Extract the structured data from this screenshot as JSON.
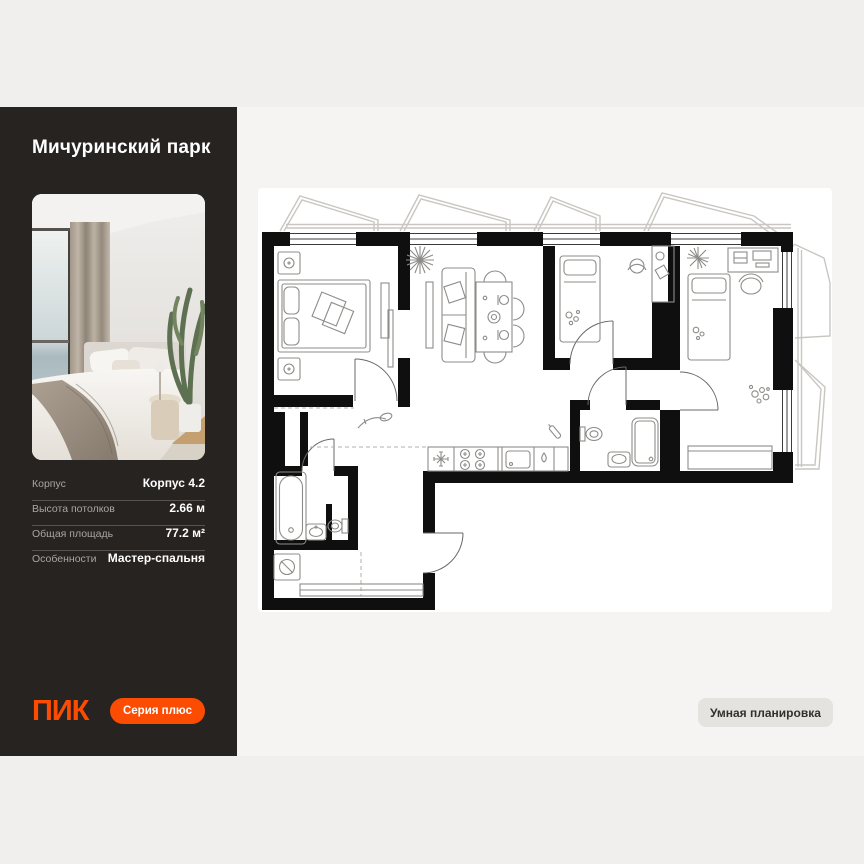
{
  "sidebar": {
    "title": "Мичуринский парк",
    "photo": "bedroom interior photo",
    "specs": [
      {
        "label": "Корпус",
        "value": "Корпус 4.2"
      },
      {
        "label": "Высота потолков",
        "value": "2.66 м"
      },
      {
        "label": "Общая площадь",
        "value": "77.2 м²"
      },
      {
        "label": "Особенности",
        "value": "Мастер-спальня"
      }
    ],
    "logo": "ПИК",
    "series_button": "Серия плюс"
  },
  "plan": {
    "badge": "Умная планировка",
    "icons": [
      "double-bed",
      "sofa",
      "dining-table",
      "single-bed",
      "desk",
      "office-chair",
      "bathtub",
      "toilet",
      "sink",
      "shower",
      "washing-machine",
      "stove",
      "cooker-hood",
      "kitchen-sink",
      "kettle",
      "plant",
      "toys",
      "balcony",
      "door-arc",
      "window"
    ]
  },
  "colors": {
    "accent": "#fc4c02",
    "sidebar_bg": "#272320",
    "page_bg": "#f0efed",
    "panel_bg": "#f5f4f2",
    "card_bg": "#ffffff",
    "badge_bg": "#e4e3e0"
  }
}
